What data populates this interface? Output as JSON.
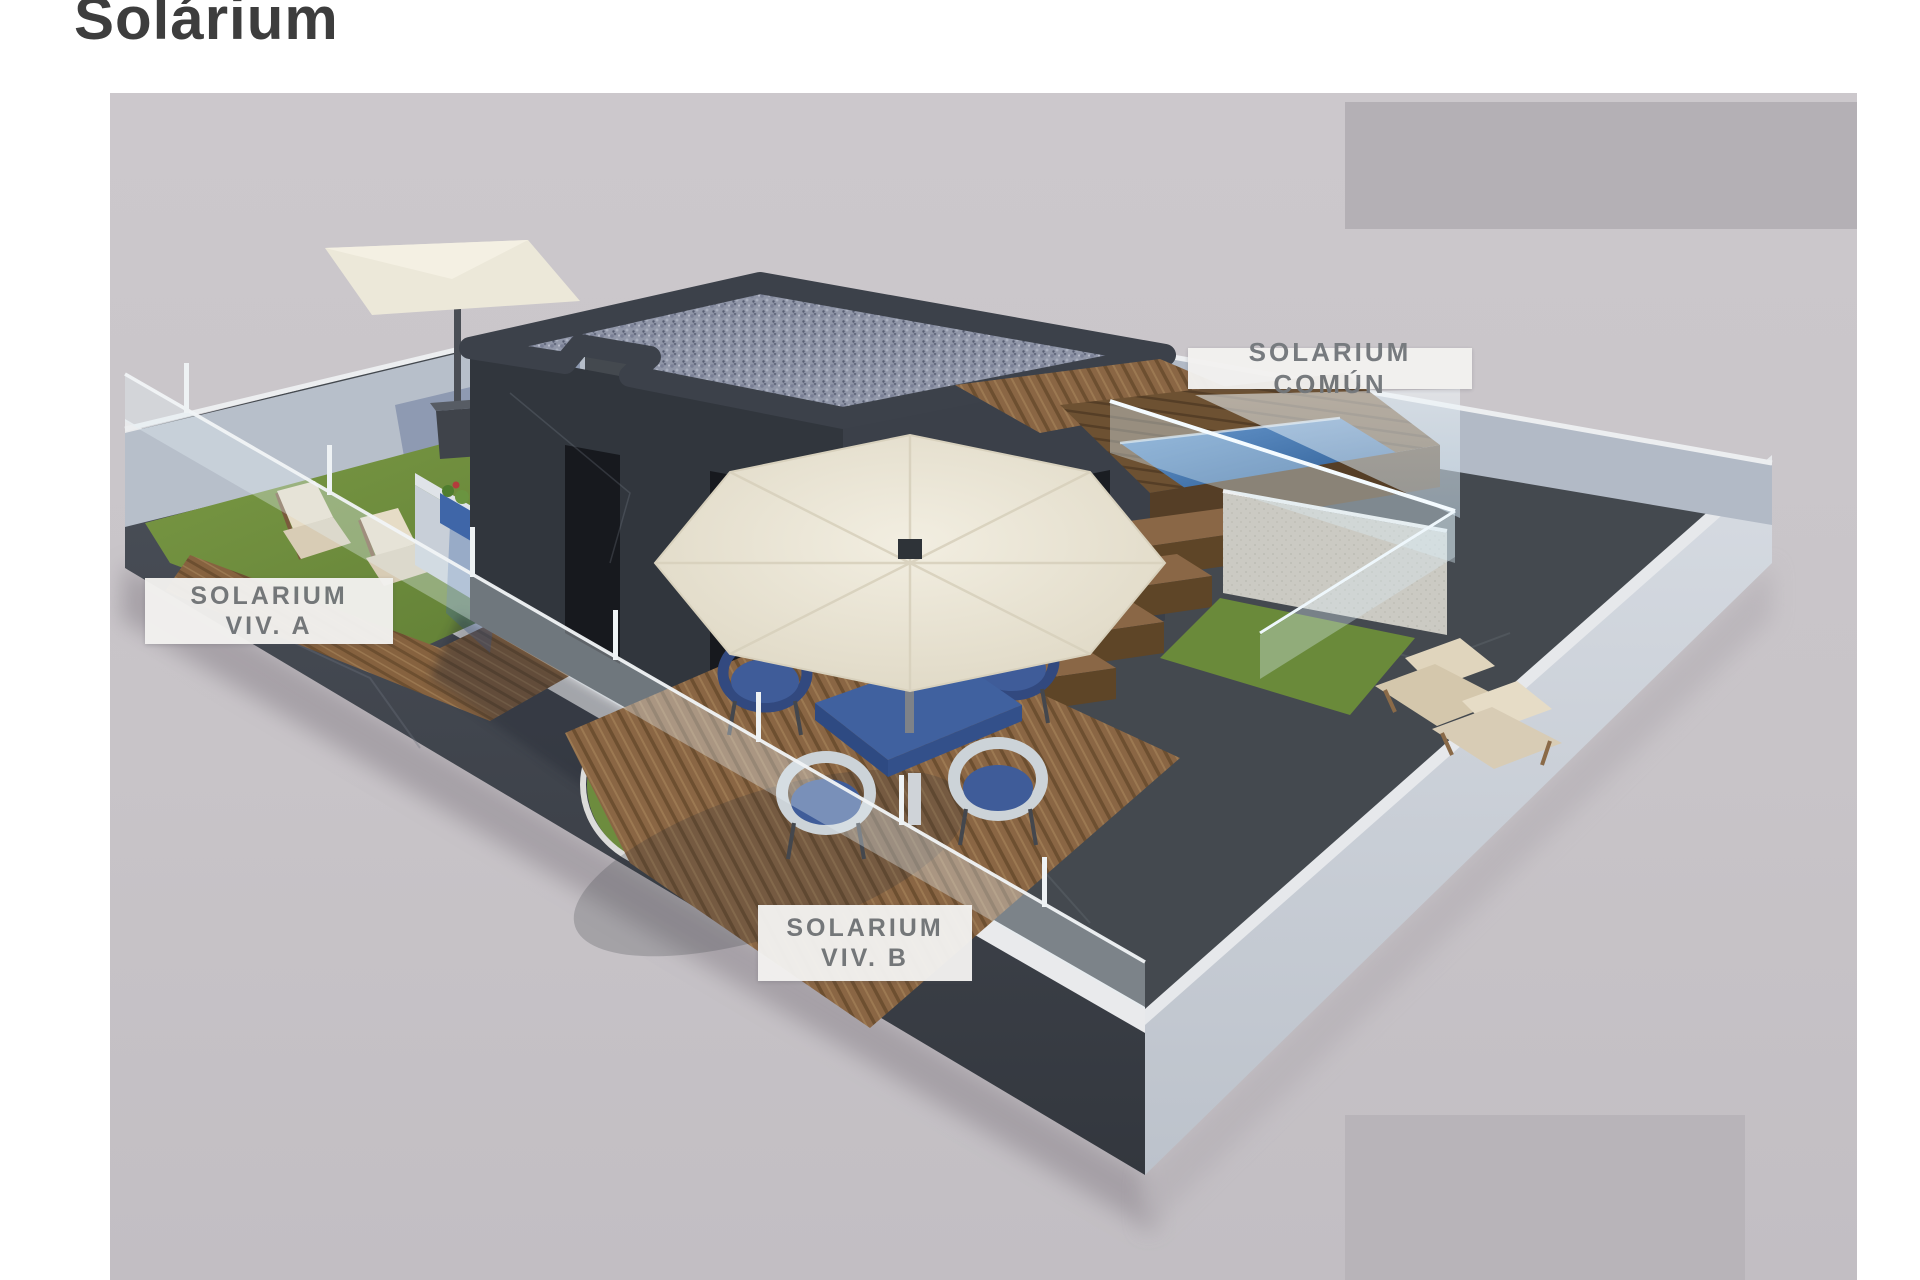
{
  "page": {
    "title": "Solárium"
  },
  "labels": {
    "viv_a": {
      "line1": "SOLARIUM",
      "line2": "VIV. A"
    },
    "viv_b": {
      "line1": "SOLARIUM",
      "line2": "VIV. B"
    },
    "comun": {
      "line1": "SOLARIUM COMÚN"
    }
  },
  "palette": {
    "page_bg": "#ffffff",
    "title_color": "#3d3d3d",
    "render_bg_top": "#ccc8cc",
    "render_bg_bottom": "#c2bec3",
    "overlay_gray": "#b4b0b5",
    "label_bg": "#f3f2f0",
    "label_text": "#74787c",
    "wall_dark_charcoal": "#3f444c",
    "wall_light_blue": "#b7bfca",
    "slate_floor": "#44494f",
    "wood_deck": "#86623f",
    "grass_green": "#6f8f3f",
    "pool_water": "#4a7fb5",
    "parasol_cream": "#ece7d8",
    "furniture_blue": "#3f5c99",
    "glass": "#d9ebf3"
  }
}
